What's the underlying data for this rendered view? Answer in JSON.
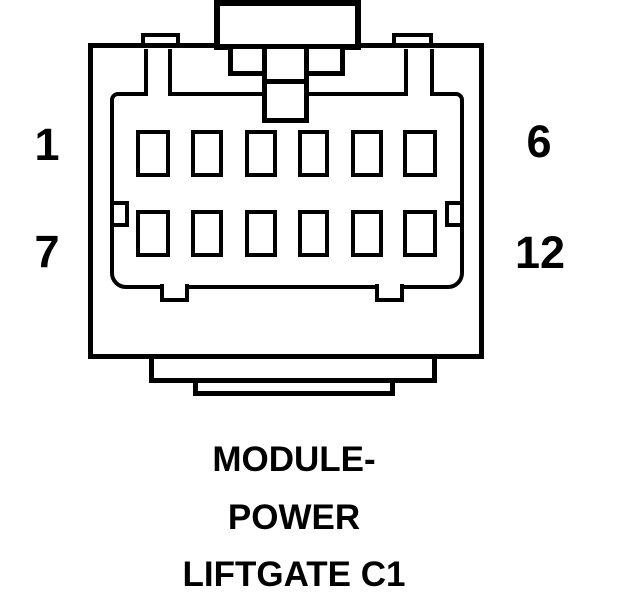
{
  "diagram": {
    "type": "connector-pinout",
    "colors": {
      "line": "#000000",
      "background": "#ffffff"
    },
    "connector": {
      "pin_total": 12,
      "rows": 2,
      "columns": 6,
      "pin_labels": {
        "top_left": "1",
        "top_right": "6",
        "bottom_left": "7",
        "bottom_right": "12"
      },
      "caption_lines": [
        "MODULE-",
        "POWER",
        "LIFTGATE C1"
      ]
    }
  }
}
